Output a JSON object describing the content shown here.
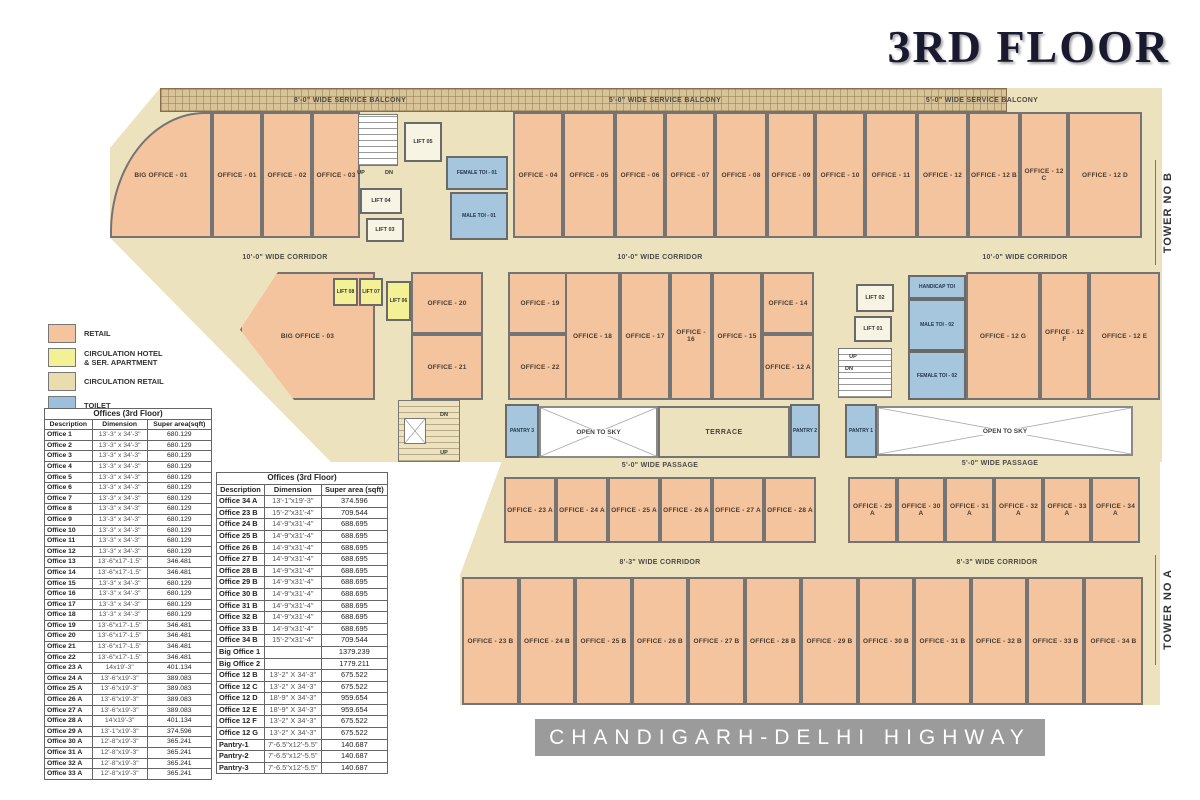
{
  "title": "3RD FLOOR",
  "banner": "CHANDIGARH-DELHI HIGHWAY",
  "colors": {
    "retail": "#F4C49E",
    "circulation_hotel": "#F3F096",
    "circulation_retail": "#EADCAE",
    "toilet": "#9CC0DC",
    "banner_gray": "#9B9B9B"
  },
  "legend": {
    "items": [
      {
        "label": "RETAIL"
      },
      {
        "label": "CIRCULATION HOTEL\n& SER. APARTMENT"
      },
      {
        "label": "CIRCULATION RETAIL"
      },
      {
        "label": "TOILET"
      }
    ]
  },
  "plan": {
    "rooms": [
      {
        "id": "svc-balcony-label-1",
        "label": "8'-0\" WIDE SERVICE BALCONY",
        "type": "label"
      },
      {
        "id": "svc-balcony-label-2",
        "label": "5'-0\" WIDE SERVICE BALCONY",
        "type": "label"
      },
      {
        "id": "svc-balcony-label-3",
        "label": "5'-0\" WIDE SERVICE BALCONY",
        "type": "label"
      },
      {
        "id": "big-office-01",
        "label": "BIG OFFICE - 01",
        "type": "retail"
      },
      {
        "id": "office-01",
        "label": "OFFICE - 01",
        "type": "retail"
      },
      {
        "id": "office-02",
        "label": "OFFICE - 02",
        "type": "retail"
      },
      {
        "id": "office-03",
        "label": "OFFICE - 03",
        "type": "retail"
      },
      {
        "id": "stair-1",
        "label": "",
        "type": "stairw"
      },
      {
        "id": "up-1",
        "label": "UP",
        "type": "tiny"
      },
      {
        "id": "dn-1",
        "label": "DN",
        "type": "tiny"
      },
      {
        "id": "lift-05",
        "label": "LIFT 05",
        "type": "lift"
      },
      {
        "id": "lift-04",
        "label": "LIFT 04",
        "type": "lift"
      },
      {
        "id": "lift-03",
        "label": "LIFT 03",
        "type": "lift"
      },
      {
        "id": "female-toi-01",
        "label": "FEMALE TOI - 01",
        "type": "toilet"
      },
      {
        "id": "male-toi-01",
        "label": "MALE TOI - 01",
        "type": "toilet"
      },
      {
        "id": "office-04",
        "label": "OFFICE - 04",
        "type": "retail"
      },
      {
        "id": "office-05",
        "label": "OFFICE - 05",
        "type": "retail"
      },
      {
        "id": "office-06",
        "label": "OFFICE - 06",
        "type": "retail"
      },
      {
        "id": "office-07",
        "label": "OFFICE - 07",
        "type": "retail"
      },
      {
        "id": "office-08",
        "label": "OFFICE - 08",
        "type": "retail"
      },
      {
        "id": "office-09",
        "label": "OFFICE - 09",
        "type": "retail"
      },
      {
        "id": "office-10",
        "label": "OFFICE - 10",
        "type": "retail"
      },
      {
        "id": "office-11",
        "label": "OFFICE - 11",
        "type": "retail"
      },
      {
        "id": "office-12",
        "label": "OFFICE - 12",
        "type": "retail"
      },
      {
        "id": "office-12b",
        "label": "OFFICE - 12 B",
        "type": "retail"
      },
      {
        "id": "office-12c",
        "label": "OFFICE - 12 C",
        "type": "retail"
      },
      {
        "id": "office-12d",
        "label": "OFFICE - 12 D",
        "type": "retail"
      },
      {
        "id": "corridor-b-label-1",
        "label": "10'-0\" WIDE CORRIDOR",
        "type": "label"
      },
      {
        "id": "corridor-b-label-2",
        "label": "10'-0\" WIDE CORRIDOR",
        "type": "label"
      },
      {
        "id": "corridor-b-label-3",
        "label": "10'-0\" WIDE CORRIDOR",
        "type": "label"
      },
      {
        "id": "big-office-03",
        "label": "BIG OFFICE - 03",
        "type": "retail"
      },
      {
        "id": "lift-08",
        "label": "LIFT 08",
        "type": "lifty"
      },
      {
        "id": "lift-07",
        "label": "LIFT 07",
        "type": "lifty"
      },
      {
        "id": "lift-06",
        "label": "LIFT 06",
        "type": "lifty"
      },
      {
        "id": "office-20",
        "label": "OFFICE - 20",
        "type": "retail"
      },
      {
        "id": "office-21",
        "label": "OFFICE - 21",
        "type": "retail"
      },
      {
        "id": "office-19",
        "label": "OFFICE - 19",
        "type": "retail"
      },
      {
        "id": "office-22",
        "label": "OFFICE - 22",
        "type": "retail"
      },
      {
        "id": "office-18",
        "label": "OFFICE - 18",
        "type": "retail"
      },
      {
        "id": "office-17",
        "label": "OFFICE - 17",
        "type": "retail"
      },
      {
        "id": "office-16",
        "label": "OFFICE - 16",
        "type": "retail"
      },
      {
        "id": "office-15",
        "label": "OFFICE - 15",
        "type": "retail"
      },
      {
        "id": "office-14",
        "label": "OFFICE - 14",
        "type": "retail"
      },
      {
        "id": "office-12a",
        "label": "OFFICE - 12 A",
        "type": "retail"
      },
      {
        "id": "lift-02",
        "label": "LIFT 02",
        "type": "lift"
      },
      {
        "id": "lift-01",
        "label": "LIFT 01",
        "type": "lift"
      },
      {
        "id": "stair-2",
        "label": "",
        "type": "stairw"
      },
      {
        "id": "up-2",
        "label": "UP",
        "type": "tiny"
      },
      {
        "id": "dn-2",
        "label": "DN",
        "type": "tiny"
      },
      {
        "id": "handicap-toi",
        "label": "HANDICAP TOI",
        "type": "toilet"
      },
      {
        "id": "male-toi-02",
        "label": "MALE TOI - 02",
        "type": "toilet"
      },
      {
        "id": "female-toi-02",
        "label": "FEMALE TOI - 02",
        "type": "toilet"
      },
      {
        "id": "office-12g",
        "label": "OFFICE - 12 G",
        "type": "retail"
      },
      {
        "id": "office-12f",
        "label": "OFFICE - 12 F",
        "type": "retail"
      },
      {
        "id": "office-12e",
        "label": "OFFICE - 12 E",
        "type": "retail"
      },
      {
        "id": "stair-3",
        "label": "",
        "type": "stairt"
      },
      {
        "id": "dn-3",
        "label": "DN",
        "type": "tiny"
      },
      {
        "id": "up-3",
        "label": "UP",
        "type": "tiny"
      },
      {
        "id": "liftx-1",
        "label": "",
        "type": "liftx"
      },
      {
        "id": "pantry-3",
        "label": "PANTRY 3",
        "type": "toilet"
      },
      {
        "id": "open-sky-1",
        "label": "OPEN TO SKY",
        "type": "sky"
      },
      {
        "id": "terrace",
        "label": "TERRACE",
        "type": "circ"
      },
      {
        "id": "pantry-2",
        "label": "PANTRY 2",
        "type": "toilet"
      },
      {
        "id": "pantry-1",
        "label": "PANTRY 1",
        "type": "toilet"
      },
      {
        "id": "open-sky-2",
        "label": "OPEN TO SKY",
        "type": "sky"
      },
      {
        "id": "passage-label-1",
        "label": "5'-0\" WIDE PASSAGE",
        "type": "label"
      },
      {
        "id": "passage-label-2",
        "label": "5'-0\" WIDE PASSAGE",
        "type": "label"
      },
      {
        "id": "office-23a",
        "label": "OFFICE - 23 A",
        "type": "retail"
      },
      {
        "id": "office-24a",
        "label": "OFFICE - 24 A",
        "type": "retail"
      },
      {
        "id": "office-25a",
        "label": "OFFICE - 25 A",
        "type": "retail"
      },
      {
        "id": "office-26a",
        "label": "OFFICE - 26 A",
        "type": "retail"
      },
      {
        "id": "office-27a",
        "label": "OFFICE - 27 A",
        "type": "retail"
      },
      {
        "id": "office-28a",
        "label": "OFFICE - 28 A",
        "type": "retail"
      },
      {
        "id": "office-29a",
        "label": "OFFICE - 29 A",
        "type": "retail"
      },
      {
        "id": "office-30a",
        "label": "OFFICE - 30 A",
        "type": "retail"
      },
      {
        "id": "office-31a",
        "label": "OFFICE - 31 A",
        "type": "retail"
      },
      {
        "id": "office-32a",
        "label": "OFFICE - 32 A",
        "type": "retail"
      },
      {
        "id": "office-33a",
        "label": "OFFICE - 33 A",
        "type": "retail"
      },
      {
        "id": "office-34a",
        "label": "OFFICE - 34 A",
        "type": "retail"
      },
      {
        "id": "corridor-a-label-1",
        "label": "8'-3\" WIDE CORRIDOR",
        "type": "label"
      },
      {
        "id": "corridor-a-label-2",
        "label": "8'-3\" WIDE CORRIDOR",
        "type": "label"
      },
      {
        "id": "office-23b",
        "label": "OFFICE - 23 B",
        "type": "retail"
      },
      {
        "id": "office-24b",
        "label": "OFFICE - 24 B",
        "type": "retail"
      },
      {
        "id": "office-25b",
        "label": "OFFICE - 25 B",
        "type": "retail"
      },
      {
        "id": "office-26b",
        "label": "OFFICE - 26 B",
        "type": "retail"
      },
      {
        "id": "office-27b",
        "label": "OFFICE - 27 B",
        "type": "retail"
      },
      {
        "id": "office-28b",
        "label": "OFFICE - 28 B",
        "type": "retail"
      },
      {
        "id": "office-29b",
        "label": "OFFICE - 29 B",
        "type": "retail"
      },
      {
        "id": "office-30b",
        "label": "OFFICE - 30 B",
        "type": "retail"
      },
      {
        "id": "office-31b",
        "label": "OFFICE - 31 B",
        "type": "retail"
      },
      {
        "id": "office-32b",
        "label": "OFFICE - 32 B",
        "type": "retail"
      },
      {
        "id": "office-33b",
        "label": "OFFICE - 33 B",
        "type": "retail"
      },
      {
        "id": "office-34b",
        "label": "OFFICE - 34 B",
        "type": "retail"
      },
      {
        "id": "tower-no-b",
        "label": "TOWER NO B",
        "type": "vlabel"
      },
      {
        "id": "tower-no-a",
        "label": "TOWER NO A",
        "type": "vlabel"
      }
    ]
  },
  "tables": {
    "left": {
      "title": "Offices (3rd Floor)",
      "headers": [
        "Description",
        "Dimension",
        "Super  area(sqft)"
      ],
      "rows": [
        [
          "Office 1",
          "13'-3\" x 34'-3\"",
          "680.129"
        ],
        [
          "Office 2",
          "13'-3\" x 34'-3\"",
          "680.129"
        ],
        [
          "Office 3",
          "13'-3\" x 34'-3\"",
          "680.129"
        ],
        [
          "Office 4",
          "13'-3\" x 34'-3\"",
          "680.129"
        ],
        [
          "Office 5",
          "13'-3\" x 34'-3\"",
          "680.129"
        ],
        [
          "Office 6",
          "13'-3\" x 34'-3\"",
          "680.129"
        ],
        [
          "Office 7",
          "13'-3\" x 34'-3\"",
          "680.129"
        ],
        [
          "Office 8",
          "13'-3\" x 34'-3\"",
          "680.129"
        ],
        [
          "Office 9",
          "13'-3\" x 34'-3\"",
          "680.129"
        ],
        [
          "Office 10",
          "13'-3\" x 34'-3\"",
          "680.129"
        ],
        [
          "Office 11",
          "13'-3\" x 34'-3\"",
          "680.129"
        ],
        [
          "Office 12",
          "13'-3\" x 34'-3\"",
          "680.129"
        ],
        [
          "Office 13",
          "13'-6\"x17'-1.5\"",
          "346.481"
        ],
        [
          "Office 14",
          "13'-6\"x17'-1.5\"",
          "346.481"
        ],
        [
          "Office 15",
          "13'-3\" x 34'-3\"",
          "680.129"
        ],
        [
          "Office 16",
          "13'-3\" x 34'-3\"",
          "680.129"
        ],
        [
          "Office 17",
          "13'-3\" x 34'-3\"",
          "680.129"
        ],
        [
          "Office 18",
          "13'-3\" x 34'-3\"",
          "680.129"
        ],
        [
          "Office 19",
          "13'-6\"x17'-1.5\"",
          "346.481"
        ],
        [
          "Office 20",
          "13'-6\"x17'-1.5\"",
          "346.481"
        ],
        [
          "Office 21",
          "13'-6\"x17'-1.5\"",
          "346.481"
        ],
        [
          "Office 22",
          "13'-6\"x17'-1.5\"",
          "346.481"
        ],
        [
          "Office 23 A",
          "14x19'-3\"",
          "401.134"
        ],
        [
          "Office 24 A",
          "13'-6\"x19'-3\"",
          "389.083"
        ],
        [
          "Office 25 A",
          "13'-6\"x19'-3\"",
          "389.083"
        ],
        [
          "Office 26 A",
          "13'-6\"x19'-3\"",
          "389.083"
        ],
        [
          "Office 27 A",
          "13'-6\"x19'-3\"",
          "389.083"
        ],
        [
          "Office 28 A",
          "14'x19'-3\"",
          "401.134"
        ],
        [
          "Office 29 A",
          "13'-1\"x19'-3\"",
          "374.596"
        ],
        [
          "Office 30 A",
          "12'-8\"x19'-3\"",
          "365.241"
        ],
        [
          "Office 31 A",
          "12'-8\"x19'-3\"",
          "365.241"
        ],
        [
          "Office 32 A",
          "12'-8\"x19'-3\"",
          "365.241"
        ],
        [
          "Office 33 A",
          "12'-8\"x19'-3\"",
          "365.241"
        ]
      ]
    },
    "right": {
      "title": "Offices (3rd Floor)",
      "headers": [
        "Description",
        "Dimension",
        "Super area (sqft)"
      ],
      "rows": [
        [
          "Office 34 A",
          "13'-1\"x19'-3\"",
          "374.596"
        ],
        [
          "Office 23 B",
          "15'-2\"x31'-4\"",
          "709.544"
        ],
        [
          "Office 24 B",
          "14'-9\"x31'-4\"",
          "688.695"
        ],
        [
          "Office 25 B",
          "14'-9\"x31'-4\"",
          "688.695"
        ],
        [
          "Office 26 B",
          "14'-9\"x31'-4\"",
          "688.695"
        ],
        [
          "Office 27 B",
          "14'-9\"x31'-4\"",
          "688.695"
        ],
        [
          "Office 28 B",
          "14'-9\"x31'-4\"",
          "688.695"
        ],
        [
          "Office 29 B",
          "14'-9\"x31'-4\"",
          "688.695"
        ],
        [
          "Office 30 B",
          "14'-9\"x31'-4\"",
          "688.695"
        ],
        [
          "Office 31 B",
          "14'-9\"x31'-4\"",
          "688.695"
        ],
        [
          "Office 32 B",
          "14'-9\"x31'-4\"",
          "688.695"
        ],
        [
          "Office 33 B",
          "14'-9\"x31'-4\"",
          "688.695"
        ],
        [
          "Office 34 B",
          "15'-2\"x31'-4\"",
          "709.544"
        ],
        [
          "Big Office 1",
          "",
          "1379.239"
        ],
        [
          "Big Office 2",
          "",
          "1779.211"
        ],
        [
          "Office 12 B",
          "13'-2\" X 34'-3\"",
          "675.522"
        ],
        [
          "Office 12 C",
          "13'-2\" X 34'-3\"",
          "675.522"
        ],
        [
          "Office 12 D",
          "18'-9\" X 34'-3\"",
          "959.654"
        ],
        [
          "Office 12 E",
          "18'-9\" X 34'-3\"",
          "959.654"
        ],
        [
          "Office 12 F",
          "13'-2\" X 34'-3\"",
          "675.522"
        ],
        [
          "Office 12 G",
          "13'-2\" X 34'-3\"",
          "675.522"
        ],
        [
          "Pantry-1",
          "7'-6.5\"x12'-5.5\"",
          "140.687"
        ],
        [
          "Pantry-2",
          "7'-6.5\"x12'-5.5\"",
          "140.687"
        ],
        [
          "Pantry-3",
          "7'-6.5\"x12'-5.5\"",
          "140.687"
        ]
      ]
    }
  }
}
